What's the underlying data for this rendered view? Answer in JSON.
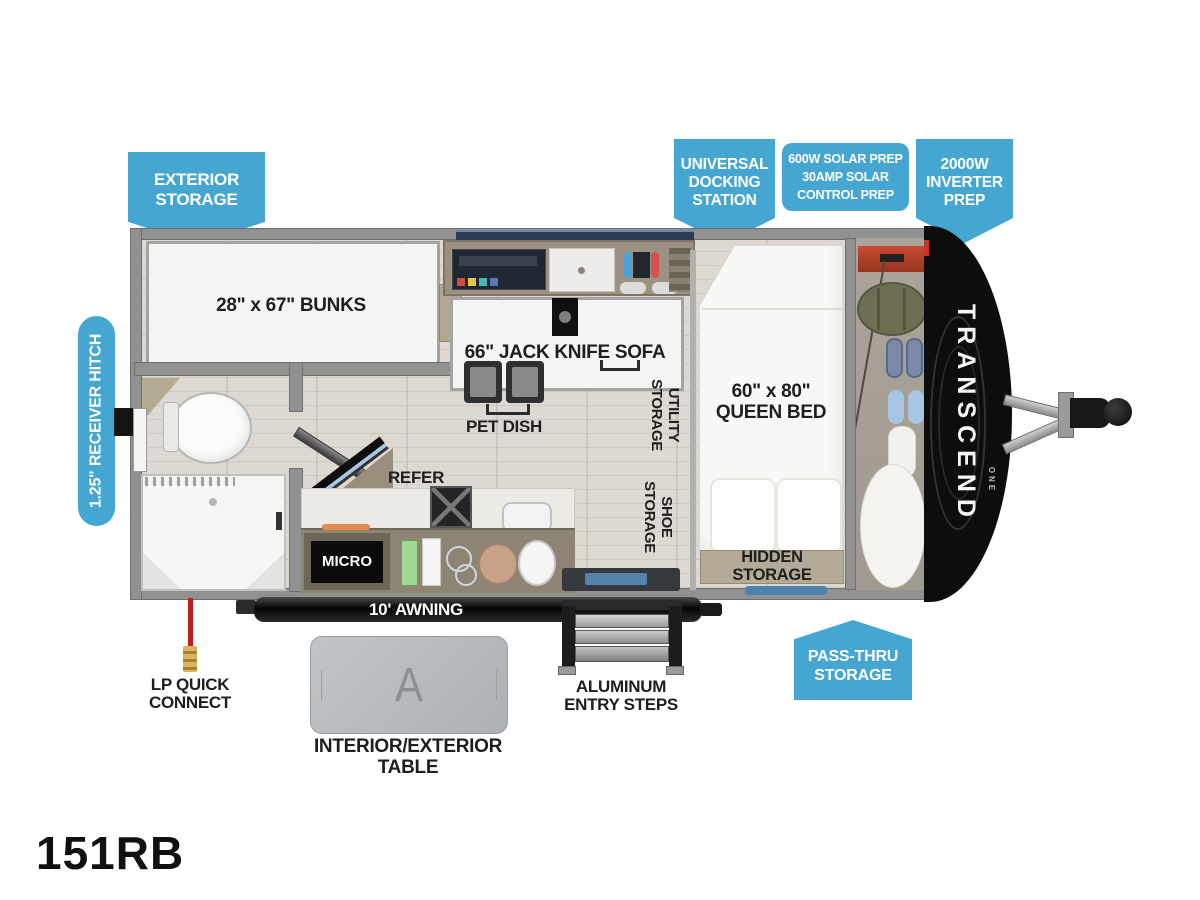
{
  "model": "151RB",
  "brand": {
    "name": "TRANSCEND",
    "line": "ONE"
  },
  "callouts": {
    "exterior_storage": "EXTERIOR\nSTORAGE",
    "universal_docking": "UNIVERSAL\nDOCKING\nSTATION",
    "solar_prep": "600W SOLAR PREP\n30AMP SOLAR\nCONTROL PREP",
    "inverter_prep": "2000W\nINVERTER\nPREP",
    "receiver_hitch": "1.25\" RECEIVER HITCH",
    "pass_thru": "PASS-THRU\nSTORAGE"
  },
  "rooms": {
    "bunks": "28\" x 67\" BUNKS",
    "sofa": "66\" JACK KNIFE SOFA",
    "pet_dish": "PET DISH",
    "refer": "REFER",
    "micro": "MICRO",
    "utility_storage": "UTILITY\nSTORAGE",
    "shoe_storage": "SHOE\nSTORAGE",
    "queen_bed": "60\" x 80\"\nQUEEN BED",
    "hidden_storage": "HIDDEN STORAGE",
    "awning": "10' AWNING"
  },
  "exterior": {
    "lp_quick_connect": "LP QUICK\nCONNECT",
    "table": "INTERIOR/EXTERIOR TABLE",
    "table_logo": "A",
    "steps": "ALUMINUM\nENTRY STEPS"
  },
  "colors": {
    "callout_blue": "#45a7d1",
    "wall_gray": "#919191",
    "floor_tan": "#ddd8d2",
    "counter_tan": "#8d8474",
    "cabinet_tan": "#9c9283",
    "cap_black": "#0d0d0d",
    "lp_red": "#c0201d",
    "mat_blue": "#4d83ad"
  }
}
